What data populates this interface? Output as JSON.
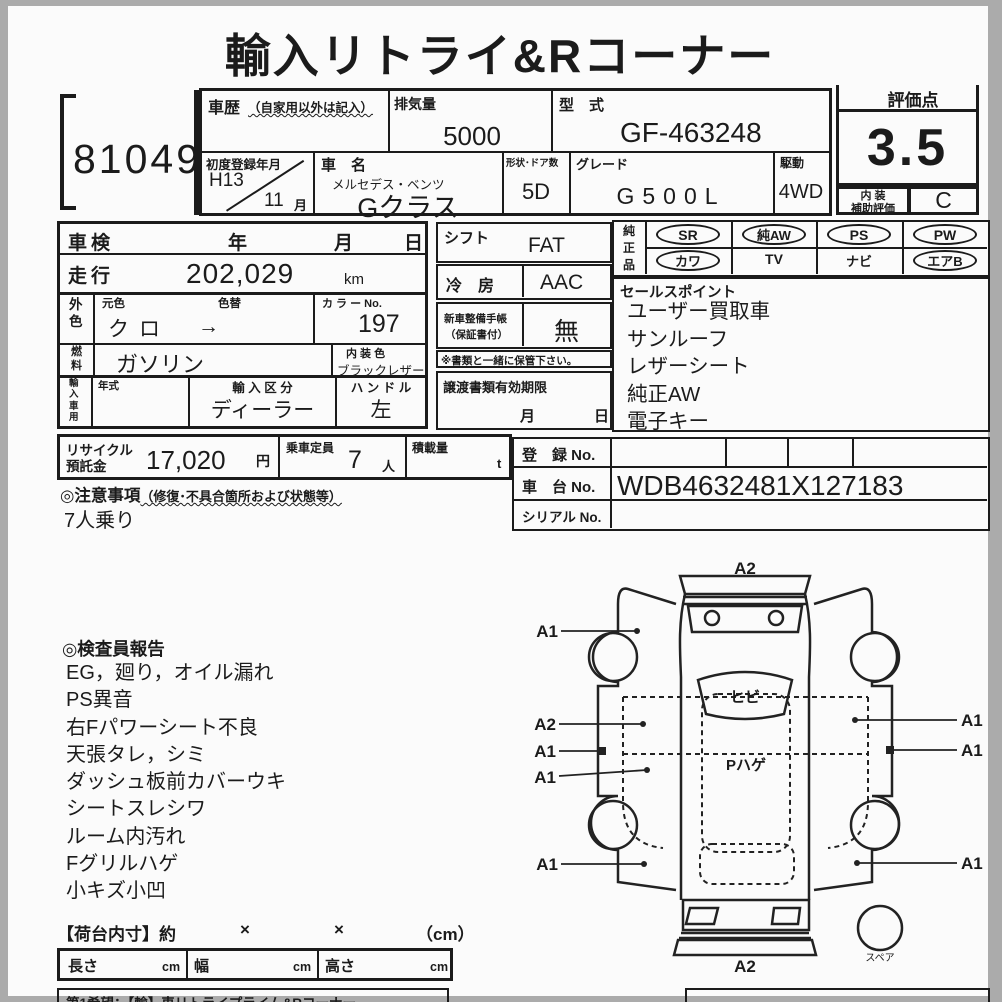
{
  "title": "輸入リトライ&Rコーナー",
  "lot_no": "81049",
  "rating": {
    "header": "評価点",
    "score": "3.5",
    "interior_line1": "内 装",
    "interior_line2": "補助評価",
    "interior_grade": "C"
  },
  "header": {
    "history_label": "車歴",
    "history_note": "（自家用以外は記入）",
    "disp_label": "排気量",
    "disp_value": "5000",
    "model_label": "型　式",
    "model_value": "GF-463248",
    "firstreg_label": "初度登録年月",
    "firstreg_year": "H13",
    "firstreg_month": "11",
    "month_unit": "月",
    "name_label": "車　名",
    "maker": "メルセデス・ベンツ",
    "name": "Gクラス",
    "shape_label": "形状･ドア数",
    "shape_value": "5D",
    "grade_label": "グレード",
    "grade_value": "G500L",
    "drive_label": "駆動",
    "drive_value": "4WD"
  },
  "left": {
    "shaken_label": "車検",
    "yy": "年",
    "mm": "月",
    "dd": "日",
    "mileage_label": "走行",
    "mileage": "202,029",
    "mileage_unit": "km",
    "extcolor_label": "外色",
    "origcolor_label": "元色",
    "origcolor": "クロ",
    "colorchg_label": "色替",
    "colorchg_arrow": "→",
    "colorno_label": "カ ラ ー No.",
    "colorno": "197",
    "fuel_label": "燃料",
    "fuel": "ガソリン",
    "intcolor_label": "内 装 色",
    "intcolor": "ブラックレザー",
    "import_label": "輸入車用",
    "nenshiki_label": "年式",
    "importclass_label": "輸 入 区 分",
    "importclass": "ディーラー",
    "handle_label": "ハ ン ド ル",
    "handle": "左"
  },
  "mid": {
    "shift_label": "シフト",
    "shift": "FAT",
    "ac_label": "冷　房",
    "ac": "AAC",
    "manual_label1": "新車整備手帳",
    "manual_label2": "（保証書付）",
    "manual": "無",
    "manual_note": "※書類と一緒に保管下さい。",
    "transfer_label": "譲渡書類有効期限",
    "transfer_mm": "月",
    "transfer_dd": "日"
  },
  "oem": {
    "label": "純正品",
    "items": [
      "SR",
      "純AW",
      "PS",
      "PW",
      "カワ",
      "TV",
      "ナビ",
      "エアB"
    ]
  },
  "sales": {
    "title": "セールスポイント",
    "items": [
      "ユーザー買取車",
      "サンルーフ",
      "レザーシート",
      "純正AW",
      "電子キー"
    ]
  },
  "recycle": {
    "label1": "リサイクル",
    "label2": "預託金",
    "value": "17,020",
    "unit": "円",
    "capacity_label": "乗車定員",
    "capacity": "7",
    "capacity_unit": "人",
    "load_label": "積載量",
    "load_unit": "t"
  },
  "caution": {
    "title_head": "◎注意事項",
    "title_note": "（修復･不具合箇所および状態等）",
    "body": "7人乗り"
  },
  "reg": {
    "reg_label": "登　録 No.",
    "chassis_label": "車　台 No.",
    "chassis": "WDB4632481X127183",
    "serial_label": "シリアル No."
  },
  "inspector": {
    "title": "◎検査員報告",
    "items": [
      "EG，廻り，オイル漏れ",
      "PS異音",
      "右Fパワーシート不良",
      "天張タレ，シミ",
      "ダッシュ板前カバーウキ",
      "シートスレシワ",
      "ルーム内汚れ",
      "Fグリルハゲ",
      "小キズ小凹"
    ]
  },
  "diagram": {
    "a2_top": "A2",
    "a1_fl": "A1",
    "a2_l": "A2",
    "a1_l1": "A1",
    "a1_l2": "A1",
    "a1_l3": "A1",
    "a1_r1": "A1",
    "a1_r2": "A1",
    "a1_r3": "A1",
    "a2_bottom": "A2",
    "windshield_note": "ヒビ",
    "roof_note": "Pハゲ",
    "spare_label": "スペア"
  },
  "cargo": {
    "title": "【荷台内寸】約",
    "x1": "×",
    "x2": "×",
    "unit": "（cm）",
    "len_label": "長さ",
    "wid_label": "幅",
    "hei_label": "高さ",
    "cm1": "cm",
    "cm2": "cm",
    "cm3": "cm"
  },
  "footer": {
    "text": "第1希望：【輸】車リトライプライム&Rコーナー"
  }
}
